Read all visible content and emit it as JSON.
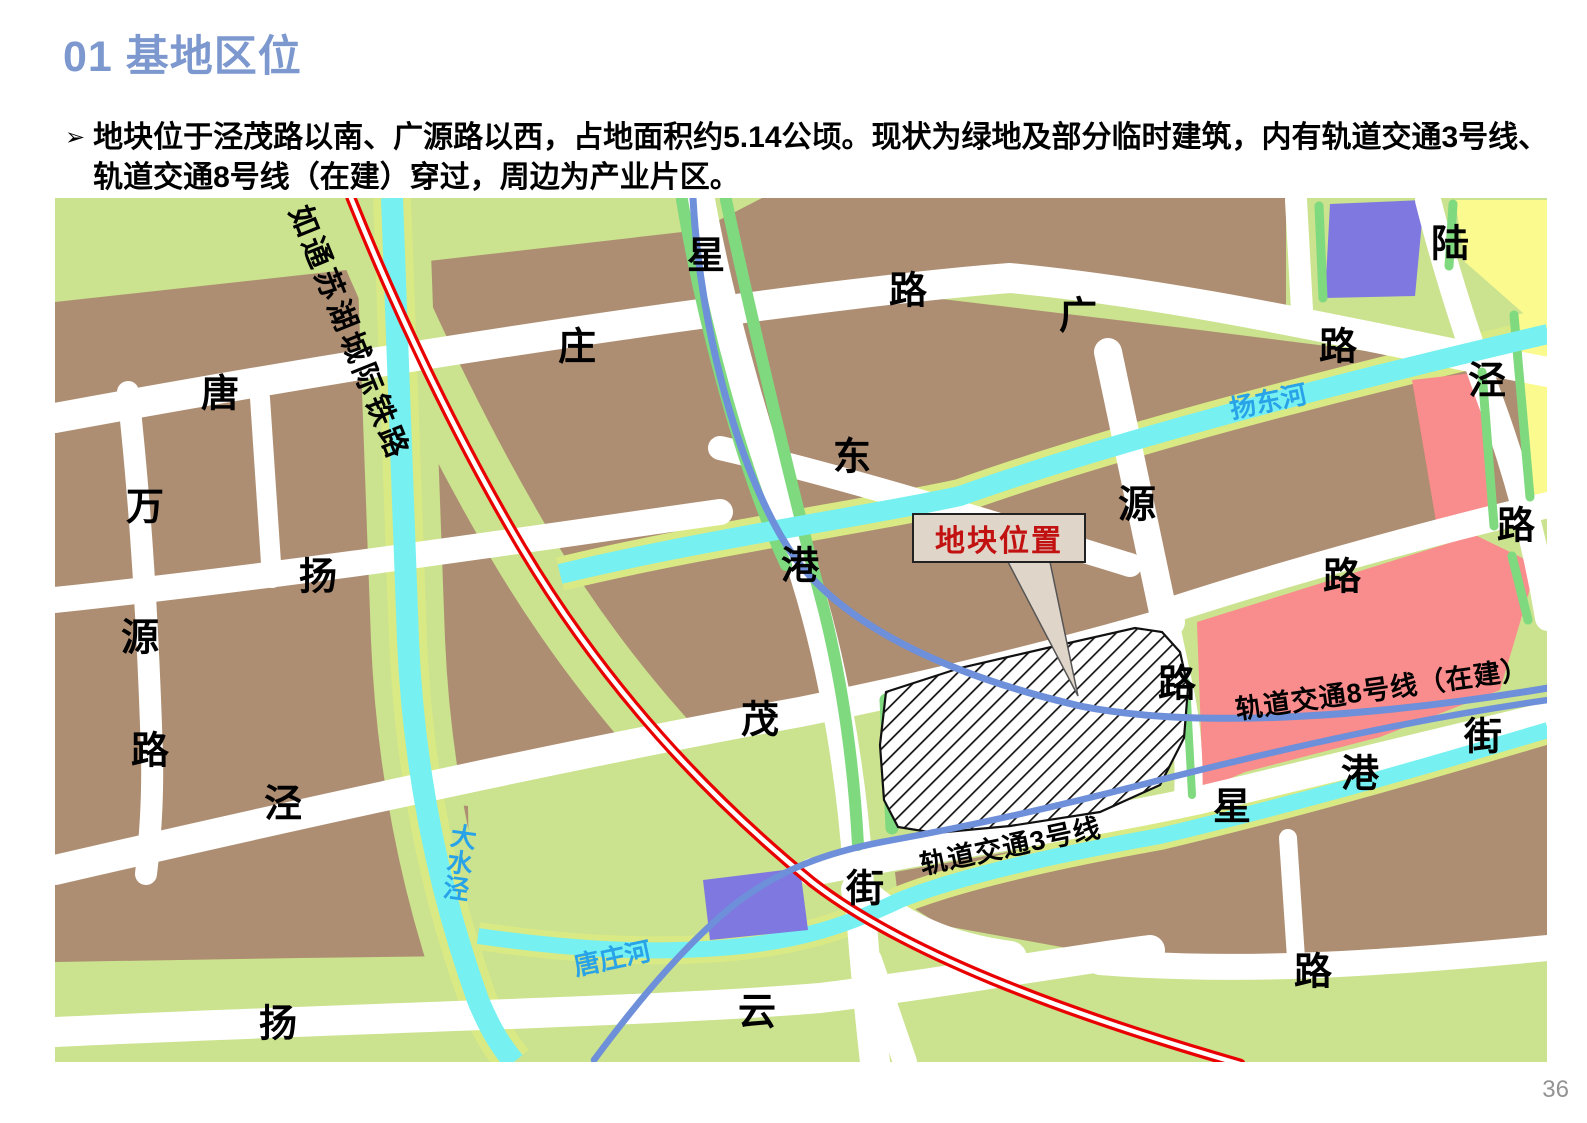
{
  "slide": {
    "title": "01 基地区位",
    "bullet_marker": "➢",
    "bullet_text": "地块位于泾茂路以南、广源路以西，占地面积约5.14公顷。现状为绿地及部分临时建筑，内有轨道交通3号线、轨道交通8号线（在建）穿过，周边为产业片区。",
    "page_number": "36"
  },
  "map": {
    "callout": {
      "label": "地块位置"
    },
    "legend_colors": {
      "block_brown": "#AE8E72",
      "greenland_light": "#CBE28E",
      "greenland_bright": "#7FD97F",
      "river_cyan": "#76F0F0",
      "river_bank": "#D9EA85",
      "zone_pink": "#F98C8C",
      "zone_purple": "#7F78E0",
      "zone_yellow": "#FAFA8F",
      "railway_red": "#E90000",
      "metro_blue": "#6E8FD9",
      "road_white": "#FFFFFF",
      "river_label_blue": "#29A3E8",
      "callout_red": "#C21111",
      "title_blue": "#7C98CE"
    },
    "rail_line_name": "如通苏湖城际铁路",
    "metro_line_8_name": "轨道交通8号线（在建）",
    "metro_line_3_name": "轨道交通3号线",
    "rivers": [
      "扬东河",
      "大水泾",
      "唐庄河"
    ],
    "labels": [
      {
        "t": "星",
        "x": 706,
        "y": 252,
        "cls": "road",
        "n": "road-label"
      },
      {
        "t": "路",
        "x": 908,
        "y": 287,
        "cls": "road",
        "n": "road-label"
      },
      {
        "t": "庄",
        "x": 577,
        "y": 343,
        "cls": "road",
        "n": "road-label"
      },
      {
        "t": "唐",
        "x": 220,
        "y": 390,
        "cls": "road",
        "n": "road-label"
      },
      {
        "t": "广",
        "x": 1078,
        "y": 312,
        "cls": "road",
        "n": "road-label"
      },
      {
        "t": "路",
        "x": 1338,
        "y": 343,
        "cls": "road",
        "n": "road-label"
      },
      {
        "t": "陆",
        "x": 1450,
        "y": 240,
        "cls": "road",
        "n": "road-label"
      },
      {
        "t": "泾",
        "x": 1487,
        "y": 377,
        "cls": "road",
        "n": "road-label"
      },
      {
        "t": "路",
        "x": 1516,
        "y": 522,
        "cls": "road",
        "n": "road-label"
      },
      {
        "t": "东",
        "x": 852,
        "y": 453,
        "cls": "road",
        "n": "road-label"
      },
      {
        "t": "源",
        "x": 1137,
        "y": 501,
        "cls": "road",
        "n": "road-label"
      },
      {
        "t": "万",
        "x": 145,
        "y": 503,
        "cls": "road",
        "n": "road-label"
      },
      {
        "t": "扬",
        "x": 318,
        "y": 573,
        "cls": "road",
        "n": "road-label"
      },
      {
        "t": "港",
        "x": 800,
        "y": 562,
        "cls": "road",
        "n": "road-label"
      },
      {
        "t": "路",
        "x": 1342,
        "y": 573,
        "cls": "road",
        "n": "road-label"
      },
      {
        "t": "源",
        "x": 140,
        "y": 634,
        "cls": "road",
        "n": "road-label"
      },
      {
        "t": "路",
        "x": 1177,
        "y": 680,
        "cls": "road",
        "n": "road-label"
      },
      {
        "t": "茂",
        "x": 760,
        "y": 716,
        "cls": "road",
        "n": "road-label"
      },
      {
        "t": "路",
        "x": 150,
        "y": 747,
        "cls": "road",
        "n": "road-label"
      },
      {
        "t": "街",
        "x": 1483,
        "y": 733,
        "cls": "road",
        "n": "road-label"
      },
      {
        "t": "港",
        "x": 1360,
        "y": 770,
        "cls": "road",
        "n": "road-label"
      },
      {
        "t": "泾",
        "x": 283,
        "y": 800,
        "cls": "road",
        "n": "road-label"
      },
      {
        "t": "星",
        "x": 1232,
        "y": 803,
        "cls": "road",
        "n": "road-label"
      },
      {
        "t": "街",
        "x": 865,
        "y": 885,
        "cls": "road",
        "n": "road-label"
      },
      {
        "t": "路",
        "x": 1313,
        "y": 968,
        "cls": "road",
        "n": "road-label"
      },
      {
        "t": "云",
        "x": 757,
        "y": 1008,
        "cls": "road",
        "n": "road-label"
      },
      {
        "t": "扬",
        "x": 278,
        "y": 1020,
        "cls": "road",
        "n": "road-label"
      },
      {
        "t": "如通苏湖城际铁路",
        "x": 352,
        "y": 332,
        "r": 68,
        "s": 30,
        "cls": "rail",
        "n": "rail-label"
      },
      {
        "t": "轨道交通8号线（在建）",
        "x": 1382,
        "y": 687,
        "r": -8,
        "s": 27,
        "cls": "metro",
        "n": "metro-label"
      },
      {
        "t": "轨道交通3号线",
        "x": 1010,
        "y": 844,
        "r": -12,
        "s": 27,
        "cls": "metro",
        "n": "metro-label"
      },
      {
        "t": "扬东河",
        "x": 1268,
        "y": 400,
        "r": -12,
        "s": 26,
        "cls": "river",
        "n": "river-label"
      },
      {
        "t": "唐庄河",
        "x": 612,
        "y": 957,
        "r": -12,
        "s": 26,
        "cls": "river",
        "n": "river-label"
      },
      {
        "t": "大水泾",
        "x": 459,
        "y": 862,
        "r": 8,
        "s": 26,
        "cls": "river vert",
        "n": "river-label"
      }
    ]
  }
}
